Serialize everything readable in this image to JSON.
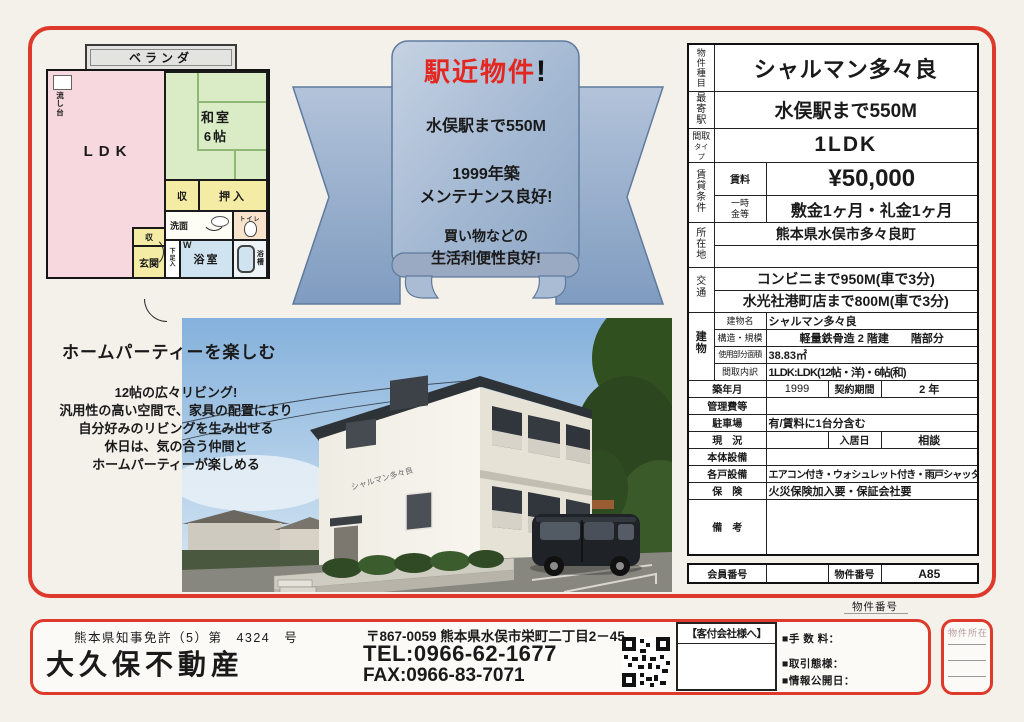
{
  "colors": {
    "accent_red": "#dd3a2b",
    "ribbon_blue": "#9fb4cf",
    "headline_red": "#e3261f"
  },
  "floorplan": {
    "veranda": "ベランダ",
    "ldk": "LDK",
    "sink": "流し台",
    "washitsu": "和室",
    "washitsu_size": "6帖",
    "closet": "収",
    "oshiire": "押入",
    "senmen": "洗面",
    "toilet": "トイレ",
    "closet2": "収",
    "geta": "下足入",
    "bath": "浴室",
    "w_mark": "W",
    "tub": "浴槽",
    "genkan": "玄関"
  },
  "ribbon": {
    "headline": "駅近物件",
    "headline_excl": "!",
    "line1": "水俣駅まで550M",
    "line2": "1999年築",
    "line3": "メンテナンス良好!",
    "line4": "買い物などの",
    "line5": "生活利便性良好!"
  },
  "party": {
    "heading": "ホームパーティーを楽しむ",
    "line1": "12帖の広々リビング!",
    "line2": "汎用性の高い空間で、家具の配置により",
    "line3": "自分好みのリビングを生み出せる",
    "line4": "休日は、気の合う仲間と",
    "line5": "ホームパーティーが楽しめる"
  },
  "photo": {
    "building_sign": "シャルマン多々良"
  },
  "table": {
    "type_label": "物件種目",
    "name": "シャルマン多々良",
    "station_label": "最寄駅",
    "station": "水俣駅まで550M",
    "madori_label": "間取",
    "madori_label2": "タイプ",
    "madori": "1LDK",
    "chintai_label": "賃貸条件",
    "rent_label": "賃料",
    "rent": "¥50,000",
    "ichiji_label": "一時金等",
    "ichiji": "敷金1ヶ月・礼金1ヶ月",
    "location_label": "所在地",
    "location": "熊本県水俣市多々良町",
    "location2": "",
    "access_label": "交通",
    "access1": "コンビニまで950M(車で3分)",
    "access2": "水光社港町店まで800M(車で3分)",
    "building_label": "建物",
    "b1_label": "建物名",
    "b1": "シャルマン多々良",
    "b2_label": "構造・規模",
    "b2": "軽量鉄骨造 2 階建　　階部分",
    "b3_label": "使用部分面積",
    "b3": "38.83㎡",
    "b4_label": "間取内訳",
    "b4": "1LDK:LDK(12帖・洋)・6帖(和)",
    "built_label": "築年月",
    "built": "1999",
    "keiyaku_label": "契約期間",
    "keiyaku": "2 年",
    "kanri_label": "管理費等",
    "kanri": "",
    "parking_label": "駐車場",
    "parking": "有/賃料に1台分含む",
    "genkyo_label": "現　況",
    "genkyo": "",
    "nyukyo_label": "入居日",
    "nyukyo": "相談",
    "hontai_label": "本体設備",
    "hontai": "",
    "kakudo_label": "各戸設備",
    "kakudo": "エアコン付き・ウォシュレット付き・雨戸シャッター付",
    "hoken_label": "保　険",
    "hoken": "火災保険加入要・保証会社要",
    "biko_label": "備　考",
    "biko": "",
    "member_label": "会員番号",
    "member": "",
    "bukken_label": "物件番号",
    "bukken": "A85"
  },
  "footer": {
    "license": "熊本県知事免許（5）第　4324　号",
    "company": "大久保不動産",
    "address": "〒867-0059 熊本県水俣市栄町二丁目2－45",
    "tel": "TEL:0966-62-1677",
    "fax": "FAX:0966-83-7071",
    "kyakuzuke": "【客付会社様へ】",
    "fee": "■手 数 料：",
    "torihiki": "■取引態様：",
    "joho": "■情報公開日：",
    "bukken_no": "物件番号",
    "shozai": "物件所在"
  }
}
